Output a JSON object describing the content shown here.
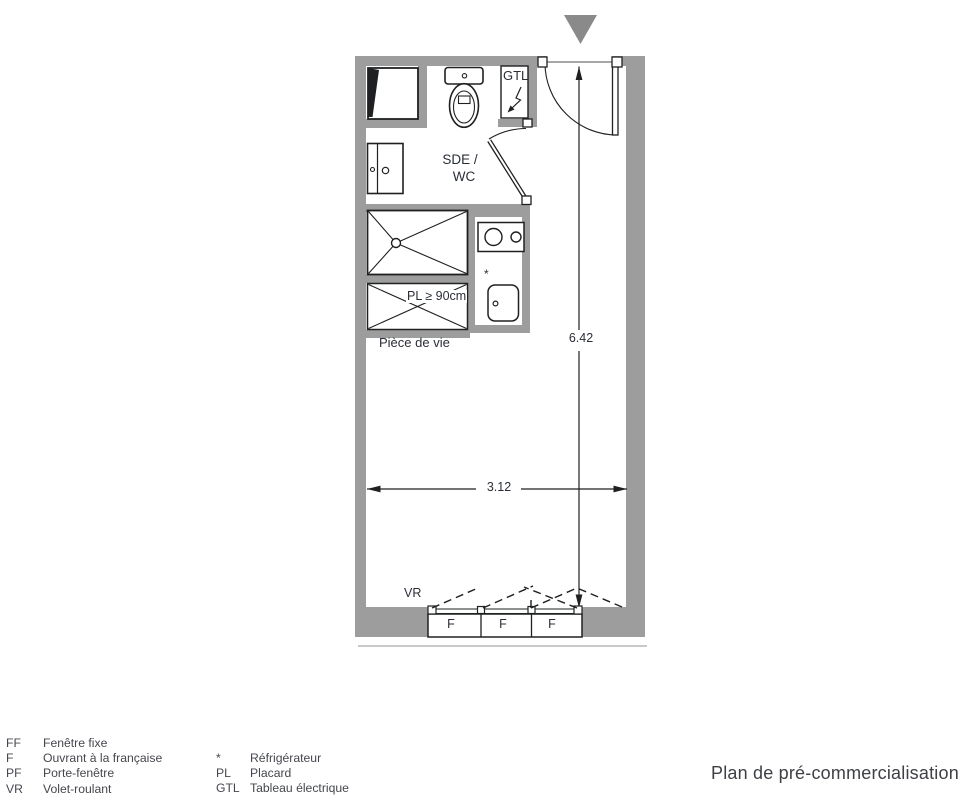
{
  "title": "Plan de pré-commercialisation",
  "plan": {
    "labels": {
      "gtl": "GTL",
      "room_line1": "SDE /",
      "room_line2": "WC",
      "placard": "PL ≥ 90cm",
      "living": "Pièce de vie",
      "shutter": "VR",
      "fridge_marker": "*"
    },
    "dimensions": {
      "height_m": "6.42",
      "width_m": "3.12"
    },
    "windows": [
      "F",
      "F",
      "F"
    ]
  },
  "legend": {
    "col1": [
      {
        "code": "FF",
        "label": "Fenêtre fixe"
      },
      {
        "code": "F",
        "label": "Ouvrant à la française"
      },
      {
        "code": "PF",
        "label": "Porte-fenêtre"
      },
      {
        "code": "VR",
        "label": "Volet-roulant"
      }
    ],
    "col2": [
      {
        "code": "*",
        "label": "Réfrigérateur"
      },
      {
        "code": "PL",
        "label": "Placard"
      },
      {
        "code": "GTL",
        "label": "Tableau électrique"
      }
    ]
  },
  "colors": {
    "wall": "#9d9d9d",
    "marker": "#8a8a8a",
    "line": "#1e2022",
    "text": "#2a2e36",
    "legend": "#45474d",
    "facade": "#c9c9c9"
  }
}
